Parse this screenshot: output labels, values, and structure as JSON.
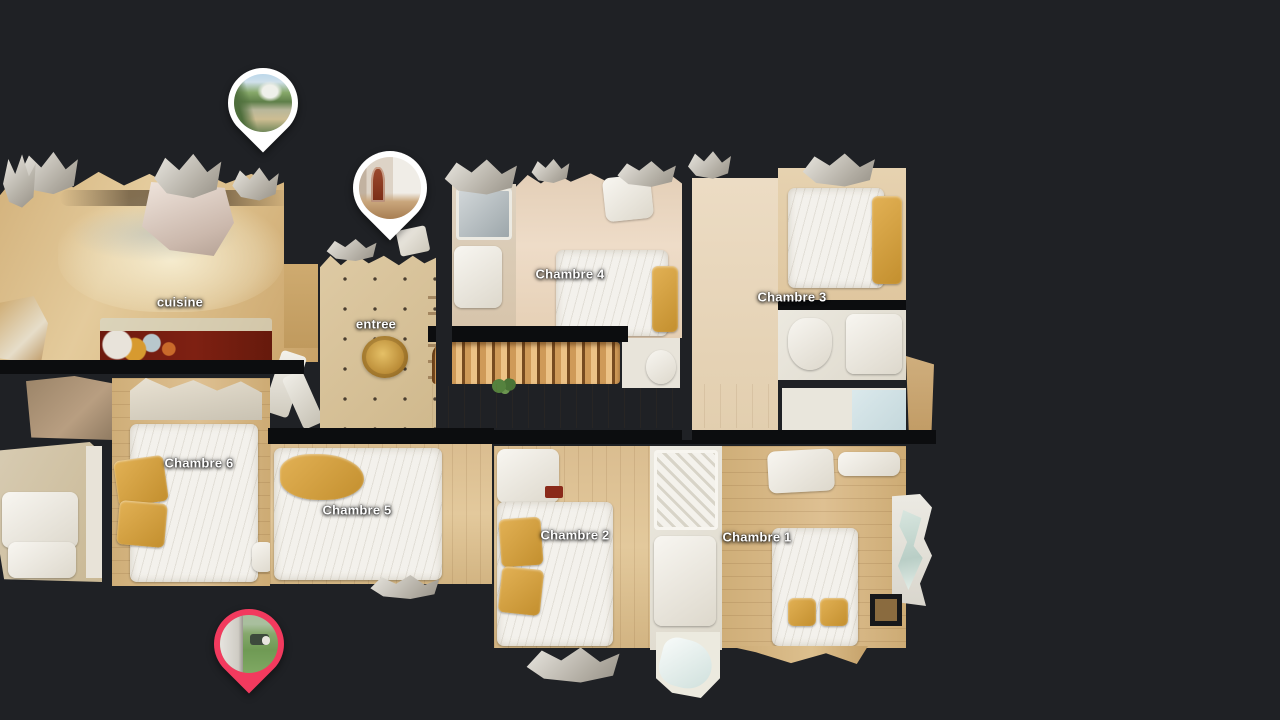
{
  "view": {
    "background_color": "#1f2125",
    "label_text_color": "#ffffff"
  },
  "rooms": [
    {
      "id": "cuisine",
      "label": "cuisine"
    },
    {
      "id": "entree",
      "label": "entree"
    },
    {
      "id": "chambre4",
      "label": "Chambre 4"
    },
    {
      "id": "chambre3",
      "label": "Chambre 3"
    },
    {
      "id": "chambre6",
      "label": "Chambre 6"
    },
    {
      "id": "chambre5",
      "label": "Chambre 5"
    },
    {
      "id": "chambre2",
      "label": "Chambre 2"
    },
    {
      "id": "chambre1",
      "label": "Chambre 1"
    }
  ],
  "pins": [
    {
      "id": "pin-garden-exterior",
      "ring_color": "#ffffff",
      "thumbnail": "garden-path-with-trees-and-house-photo"
    },
    {
      "id": "pin-entry-hallway",
      "ring_color": "#ffffff",
      "thumbnail": "hallway-with-arched-red-door-photo"
    },
    {
      "id": "pin-garden-active",
      "ring_color": "#f23a5e",
      "thumbnail": "lawn-and-wall-corner-photo"
    }
  ],
  "palette": {
    "wood_floor": "#d9ba85",
    "pale_floor": "#e8d5c0",
    "tile_floor": "#d8c49c",
    "bathroom_floor": "#e9e5dc",
    "bed_white": "#f3f1ec",
    "pillow_gold": "#d3a03f",
    "kitchen_counter_red": "#6e1a0e",
    "wall_dark": "#0c0d0f"
  }
}
